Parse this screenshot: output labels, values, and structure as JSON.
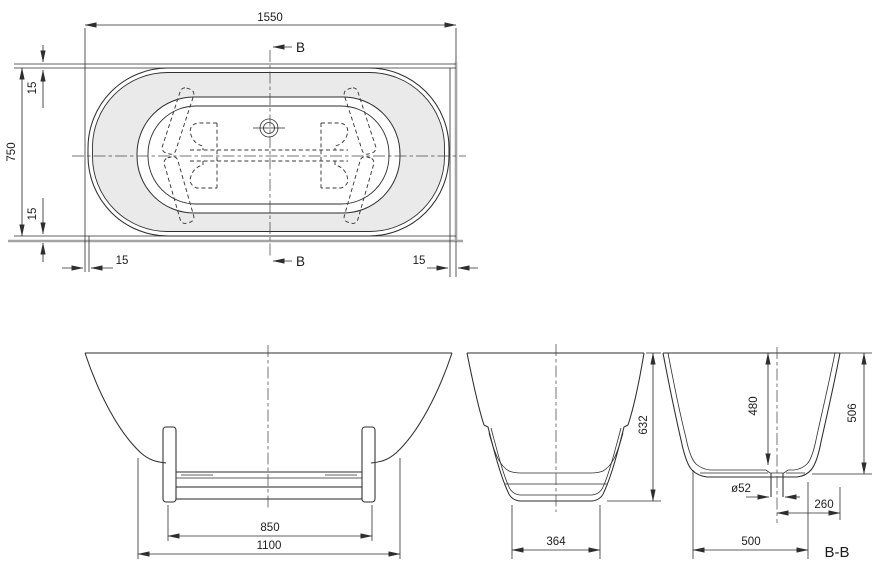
{
  "drawing": {
    "background": "#ffffff",
    "line_color": "#2e2e2e",
    "wall_color": "#a5a5a5",
    "deck_fill": "#eaeaea",
    "top_view": {
      "name": "plan-view",
      "dim_length": "1550",
      "dim_width": "750",
      "dim_clearance_top": "15",
      "dim_clearance_bottom": "15",
      "dim_clearance_left": "15",
      "dim_clearance_right": "15",
      "section_arrow_top": "B",
      "section_arrow_bottom": "B"
    },
    "front_view": {
      "name": "front-elevation",
      "dim_feet_span": "850",
      "dim_base_length": "1100"
    },
    "side_view": {
      "name": "end-elevation",
      "dim_bottom_width": "364",
      "dim_total_height": "632"
    },
    "section_view": {
      "name": "section-b-b",
      "dim_inner_depth": "480",
      "dim_shell_height": "506",
      "dim_drain_diameter": "ø52",
      "dim_drain_offset": "260",
      "dim_bottom_width": "500",
      "label": "B-B"
    }
  }
}
